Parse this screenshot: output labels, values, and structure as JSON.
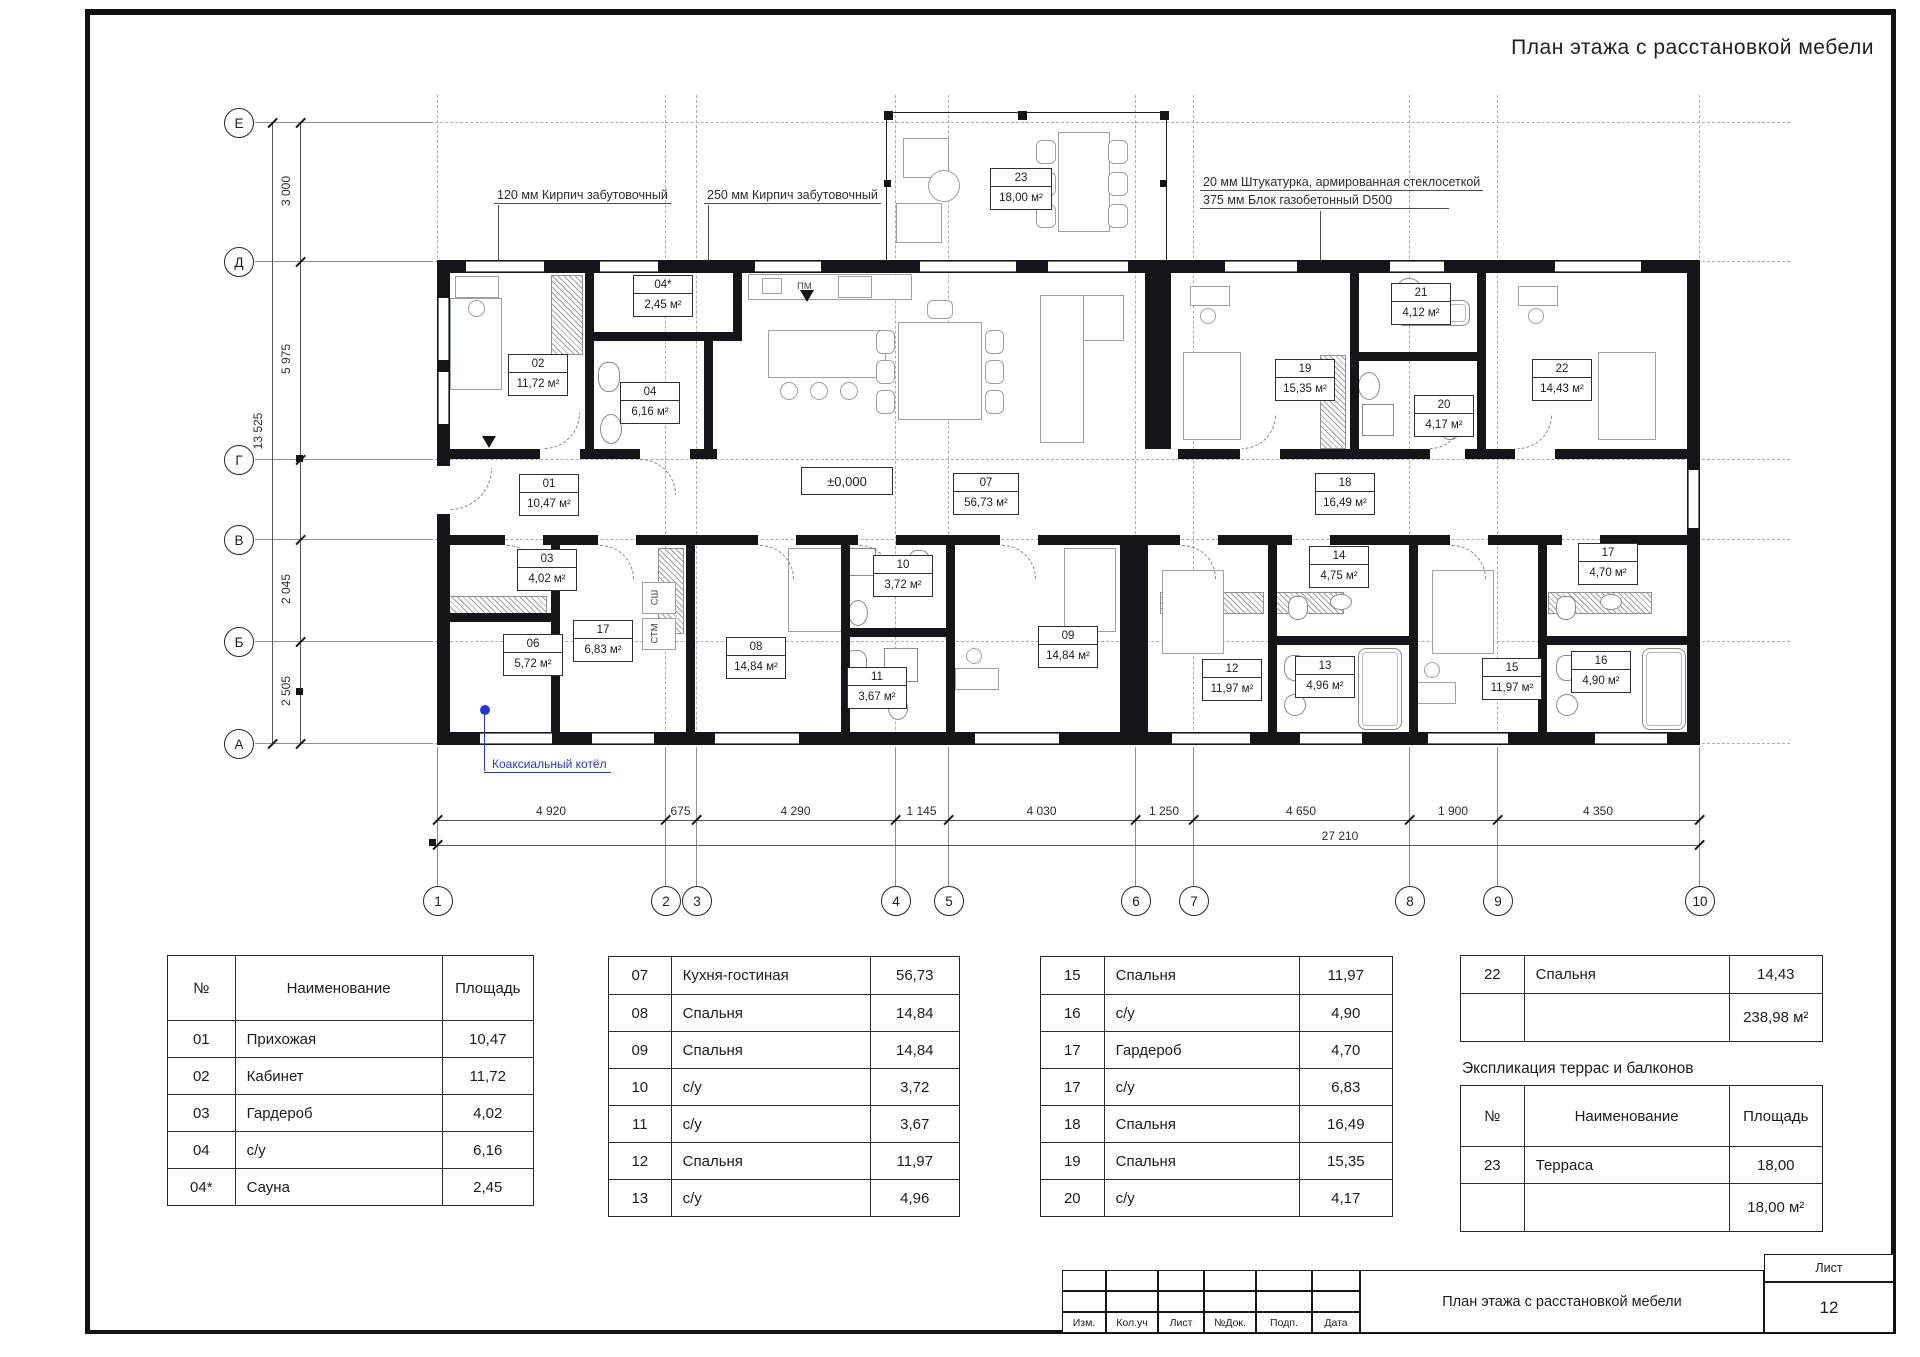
{
  "sheet": {
    "title": "План этажа с расстановкой мебели"
  },
  "annotations": {
    "brick120": "120 мм  Кирпич забутовочный",
    "brick250": "250 мм  Кирпич забутовочный",
    "plaster": "20 мм  Штукатурка, армированная стеклосеткой",
    "aerated_block": "375 мм  Блок газобетонный D500",
    "boiler": "Коаксиальный котёл",
    "level_mark": "±0,000",
    "dishwasher": "ПМ",
    "washer_top": "СШ",
    "washer_bottom": "СТМ"
  },
  "axes": {
    "vertical": [
      "1",
      "2",
      "3",
      "4",
      "5",
      "6",
      "7",
      "8",
      "9",
      "10"
    ],
    "horizontal": [
      "Е",
      "Д",
      "Г",
      "В",
      "Б",
      "А"
    ]
  },
  "dimensions": {
    "bottom_segments": [
      "4 920",
      "675",
      "4 290",
      "1 145",
      "4 030",
      "1 250",
      "4 650",
      "1 900",
      "4 350"
    ],
    "bottom_total": "27 210",
    "left_segments": [
      "3 000",
      "5 975",
      "2 045",
      "2 505"
    ],
    "left_total": "13 525"
  },
  "plan": {
    "rooms": [
      {
        "number": "02",
        "area": "11,72 м²"
      },
      {
        "number": "04*",
        "area": "2,45 м²"
      },
      {
        "number": "04",
        "area": "6,16 м²"
      },
      {
        "number": "01",
        "area": "10,47 м²"
      },
      {
        "number": "03",
        "area": "4,02 м²"
      },
      {
        "number": "06",
        "area": "5,72 м²"
      },
      {
        "number": "17",
        "area": "6,83 м²"
      },
      {
        "number": "07",
        "area": "56,73 м²"
      },
      {
        "number": "10",
        "area": "3,72 м²"
      },
      {
        "number": "11",
        "area": "3,67 м²"
      },
      {
        "number": "08",
        "area": "14,84 м²"
      },
      {
        "number": "09",
        "area": "14,84 м²"
      },
      {
        "number": "12",
        "area": "11,97 м²"
      },
      {
        "number": "13",
        "area": "4,96 м²"
      },
      {
        "number": "14",
        "area": "4,75 м²"
      },
      {
        "number": "15",
        "area": "11,97 м²"
      },
      {
        "number": "16",
        "area": "4,90 м²"
      },
      {
        "number": "17",
        "area": "4,70 м²"
      },
      {
        "number": "18",
        "area": "16,49 м²"
      },
      {
        "number": "19",
        "area": "15,35 м²"
      },
      {
        "number": "20",
        "area": "4,17 м²"
      },
      {
        "number": "21",
        "area": "4,12 м²"
      },
      {
        "number": "22",
        "area": "14,43 м²"
      },
      {
        "number": "23",
        "area": "18,00 м²"
      }
    ]
  },
  "tables": {
    "headers": [
      "№",
      "Наименование",
      "Площадь"
    ],
    "explication1": [
      [
        "01",
        "Прихожая",
        "10,47"
      ],
      [
        "02",
        "Кабинет",
        "11,72"
      ],
      [
        "03",
        "Гардероб",
        "4,02"
      ],
      [
        "04",
        "с/у",
        "6,16"
      ],
      [
        "04*",
        "Сауна",
        "2,45"
      ]
    ],
    "explication2": [
      [
        "07",
        "Кухня-гостиная",
        "56,73"
      ],
      [
        "08",
        "Спальня",
        "14,84"
      ],
      [
        "09",
        "Спальня",
        "14,84"
      ],
      [
        "10",
        "с/у",
        "3,72"
      ],
      [
        "11",
        "с/у",
        "3,67"
      ],
      [
        "12",
        "Спальня",
        "11,97"
      ],
      [
        "13",
        "с/у",
        "4,96"
      ]
    ],
    "explication3": [
      [
        "15",
        "Спальня",
        "11,97"
      ],
      [
        "16",
        "с/у",
        "4,90"
      ],
      [
        "17",
        "Гардероб",
        "4,70"
      ],
      [
        "17",
        "с/у",
        "6,83"
      ],
      [
        "18",
        "Спальня",
        "16,49"
      ],
      [
        "19",
        "Спальня",
        "15,35"
      ],
      [
        "20",
        "с/у",
        "4,17"
      ]
    ],
    "explication4": [
      [
        "22",
        "Спальня",
        "14,43"
      ]
    ],
    "explication4_total": "238,98 м²",
    "terrace_heading": "Экспликация террас и балконов",
    "terrace_rows": [
      [
        "23",
        "Терраса",
        "18,00"
      ]
    ],
    "terrace_total": "18,00 м²"
  },
  "titleblock": {
    "stamp_cells": [
      "Изм.",
      "Кол.уч",
      "Лист",
      "№Док.",
      "Подп.",
      "Дата"
    ],
    "doc_title": "План этажа с расстановкой мебели",
    "sheet_label": "Лист",
    "sheet_number": "12"
  }
}
